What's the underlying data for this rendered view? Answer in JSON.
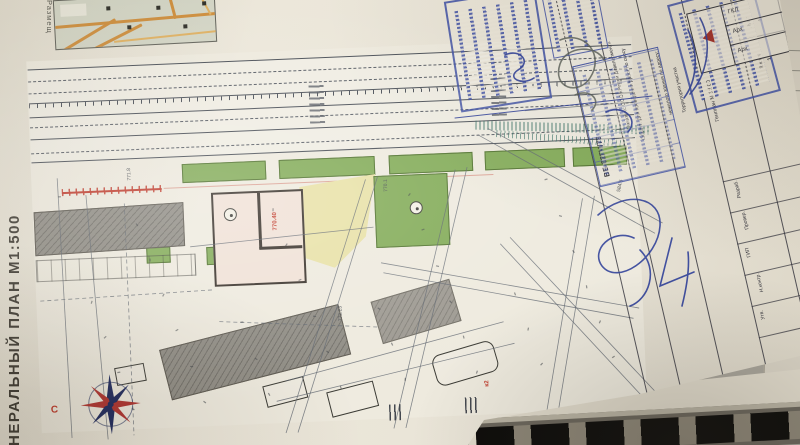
{
  "sheet": {
    "side_title": "НЕРАЛЬНЫЙ ПЛАН  М1:500",
    "inset_label": "Размещ",
    "north_label": "С"
  },
  "plan": {
    "elevation_main": "770.40",
    "elevations": [
      "772.23",
      "584.5",
      "771.8",
      "770.1"
    ],
    "red_mark": "к2"
  },
  "title_block": {
    "doc_number": "ВБ-02ГЧ/78",
    "project_lines": [
      "Заказчик: ООО «Ремни Девелопмент»",
      "Объект: Для проведения работ по сносу",
      "нежилого здания по адресу:",
      "Территория участка",
      "Генплан М 1:500"
    ],
    "row_labels": [
      "Разраб.",
      "Провер.",
      "ГИП",
      "Н.контр.",
      "Утв."
    ],
    "bottom_labels": [
      "Стадия",
      "Лист",
      "Листов"
    ],
    "bottom_values": [
      "П",
      "1",
      "1"
    ],
    "revision_cells": [
      "ГКЛ",
      "Арх",
      "Арх"
    ]
  }
}
